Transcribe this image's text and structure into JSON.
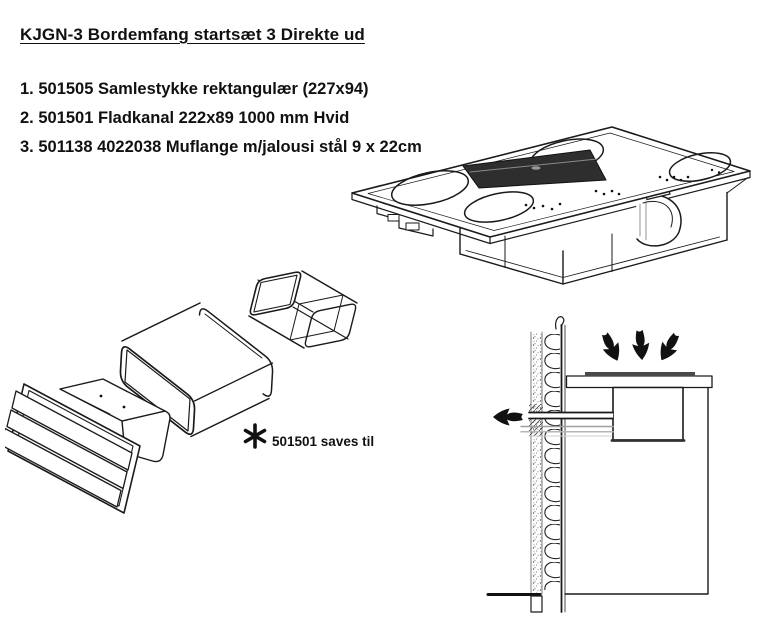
{
  "title": "KJGN-3 Bordemfang startsæt 3 Direkte ud",
  "parts_list": {
    "items": [
      "1. 501505 Samlestykke rektangulær (227x94)",
      "2. 501501 Fladkanal 222x89 1000 mm Hvid",
      "3. 501138 4022038 Muflange m/jalousi stål 9 x 22cm"
    ]
  },
  "note": {
    "marker": "✱",
    "text": "501501 saves til"
  },
  "figures": {
    "cooktop": "downdraft-cooktop-isometric-figure",
    "duct_kit": "flat-duct-and-louvre-flange-exploded-figure",
    "installation": "wall-duct-direct-out-section-figure"
  },
  "colors": {
    "background": "#ffffff",
    "ink": "#1a1a1a",
    "grille_fill": "#2e2e2e",
    "hob_strip": "#4a4a4a",
    "duct_guide_gray": "#a0a0a0"
  }
}
